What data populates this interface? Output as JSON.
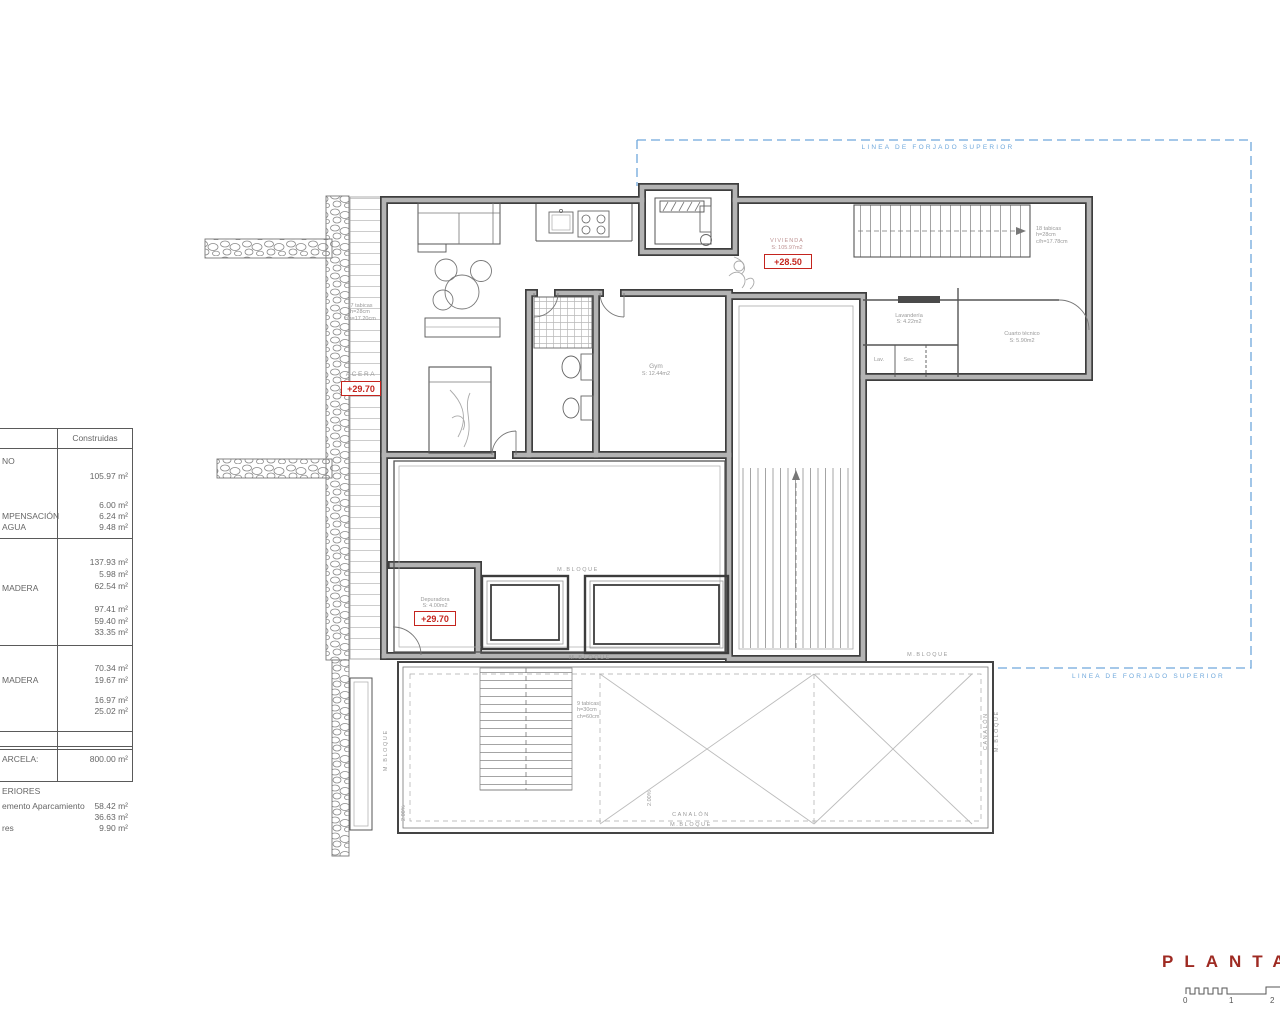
{
  "title": {
    "name": "PLANTA",
    "scale_ticks": [
      "0",
      "1",
      "2"
    ]
  },
  "forjado": {
    "top": "LINEA DE FORJADO SUPERIOR",
    "bottom": "LINEA DE FORJADO SUPERIOR"
  },
  "rooms": {
    "vivienda": {
      "name": "VIVIENDA",
      "area": "S: 105.97m2",
      "level": "+28.50"
    },
    "gym": {
      "name": "Gym",
      "area": "S: 12.44m2"
    },
    "lavanderia": {
      "name": "Lavandería",
      "area": "S: 4.22m2"
    },
    "lav": "Lav.",
    "sec": "Sec.",
    "cuarto_tecnico": {
      "name": "Cuarto técnico",
      "area": "S: 5.90m2"
    },
    "depuradora": {
      "name": "Depuradora",
      "area": "S: 4.00m2",
      "level": "+29.70"
    },
    "acera": {
      "name": "ACERA",
      "level": "+29.70"
    }
  },
  "stairs": {
    "entry": [
      "17 tabicas",
      "h=28cm",
      "c/h=17.20cm"
    ],
    "upper": [
      "18 tabicas",
      "h=28cm",
      "c/h=17.78cm"
    ],
    "roof": [
      "9 tabicas",
      "h=30cm",
      "ch=60cm"
    ]
  },
  "annotations": {
    "m_bloque": "M.BLOQUE",
    "canalon": "CANALÓN",
    "slope": "2.00%"
  },
  "areas_table": {
    "header": "Construidas",
    "labels": [
      "NO",
      "MPENSACIÓN",
      "AGUA",
      "MADERA",
      "MADERA",
      "ARCELA:"
    ],
    "values": [
      "105.97 m²",
      "6.00 m²",
      "6.24 m²",
      "9.48 m²",
      "137.93 m²",
      "5.98 m²",
      "62.54 m²",
      "97.41 m²",
      "59.40 m²",
      "33.35 m²",
      "70.34 m²",
      "19.67 m²",
      "16.97 m²",
      "25.02 m²",
      "800.00 m²"
    ],
    "footer_title": "ERIORES",
    "footer_rows": [
      {
        "label": "emento Aparcamiento",
        "value": "58.42 m²"
      },
      {
        "label": "",
        "value": "36.63 m²"
      },
      {
        "label": "res",
        "value": "9.90 m²"
      }
    ]
  },
  "colors": {
    "accent_red": "#c4241e",
    "forjado_blue": "#6fa8dc",
    "title_red": "#9e2a22"
  }
}
